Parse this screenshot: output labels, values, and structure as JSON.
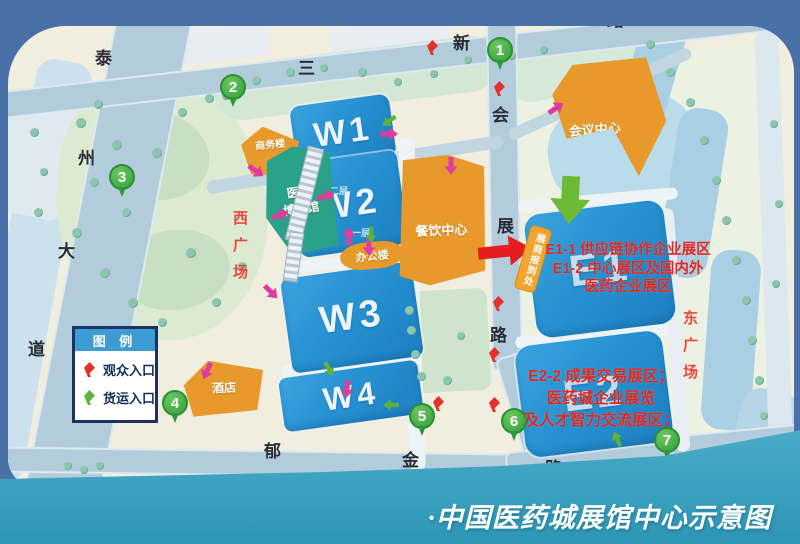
{
  "title": "·中国医药城展馆中心示意图",
  "legend": {
    "title": "图 例",
    "items": [
      {
        "icon": "red-entrance-pin",
        "label": "观众入口",
        "color": "#e0312b"
      },
      {
        "icon": "green-entrance-pin",
        "label": "货运入口",
        "color": "#5cb23c"
      }
    ]
  },
  "roads": {
    "left_vertical": {
      "chars": [
        "泰",
        "州",
        "大",
        "道"
      ]
    },
    "top": {
      "chars": [
        "三",
        "新",
        "路"
      ]
    },
    "center_vertical": {
      "chars": [
        "会",
        "展",
        "路"
      ]
    },
    "bottom": {
      "chars": [
        "郁",
        "金",
        "路"
      ]
    }
  },
  "plazas": {
    "west": "西广场",
    "east": "东广场"
  },
  "buildings": {
    "halls": [
      {
        "id": "W1",
        "label": "W1"
      },
      {
        "id": "W2",
        "label": "W2"
      },
      {
        "id": "W3",
        "label": "W3"
      },
      {
        "id": "W4",
        "label": "W4"
      },
      {
        "id": "E1",
        "label": "E1"
      },
      {
        "id": "E2",
        "label": "E2"
      }
    ],
    "facilities": [
      {
        "id": "business-building",
        "label": "商务楼"
      },
      {
        "id": "medical-expo-hall",
        "label": "医药博览馆",
        "lines": [
          "医药",
          "博览馆"
        ]
      },
      {
        "id": "office-building",
        "label": "办公楼"
      },
      {
        "id": "dining-center",
        "label": "餐饮中心"
      },
      {
        "id": "conference-center",
        "label": "会议中心"
      },
      {
        "id": "hotel",
        "label": "酒店"
      }
    ]
  },
  "labels": {
    "checkin_tag": "展商报到处",
    "floor2": "二层",
    "floor1": "一层"
  },
  "annotations": {
    "e1_lines": [
      "E1-1 供应链协作企业展区",
      "E1-2 中心展区及国内外",
      "医药企业展区"
    ],
    "e2_lines": [
      "E2-2 成果交易展区；",
      "医药城企业展览",
      "及人才智力交流展区；"
    ]
  },
  "markers": [
    "1",
    "2",
    "3",
    "4",
    "5",
    "6",
    "7"
  ],
  "colors": {
    "hall_blue": "#2792d2",
    "facility_orange": "#e8992b",
    "expo_teal": "#2aa189",
    "annotation_red": "#e3271f",
    "marker_green": "#3fa643",
    "road": "#b3ccdc",
    "background_top": "#4a70a8",
    "background_bottom": "#37a1c1",
    "pink_arrow": "#dd3d9c"
  }
}
